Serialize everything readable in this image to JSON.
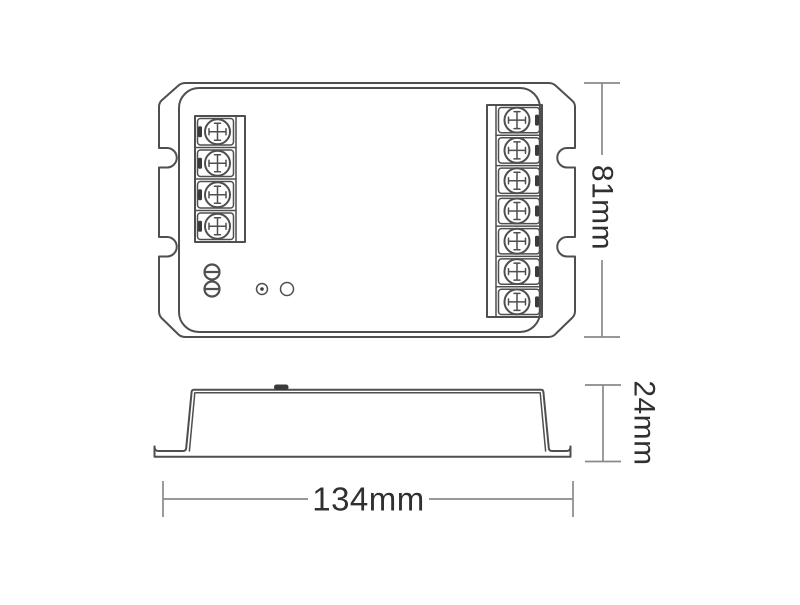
{
  "diagram": {
    "kind": "product-dimension-drawing",
    "views": {
      "top_view": {
        "left_terminal_count": 4,
        "right_terminal_count": 7,
        "adjustment_screw_count": 2,
        "has_led_indicator": true,
        "has_button": true,
        "edge_slot_count_per_side": 2
      },
      "side_view": {
        "has_top_bump": true,
        "has_mounting_flanges": true
      }
    },
    "dimensions": {
      "height_label": "81mm",
      "depth_label": "24mm",
      "width_label": "134mm"
    },
    "colors": {
      "line": "#4f4f4f",
      "dim_line": "#8a8a8a",
      "text": "#303030",
      "dark_fill": "#3a3a3a",
      "background": "#ffffff"
    }
  }
}
